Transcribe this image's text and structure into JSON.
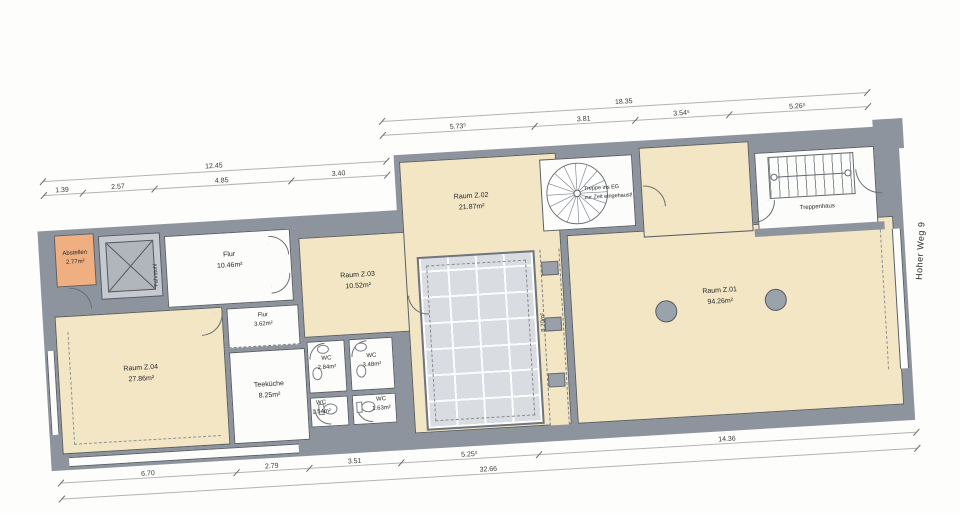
{
  "labels": {
    "street": "Hoher Weg 9",
    "treppenhaus": "Treppenhaus",
    "fahrstuhl": "Fahrstuhl",
    "lightwell_area": "8.70m²",
    "stair_note": [
      "Treppe ins EG",
      "zur Zeit eingehaust!"
    ]
  },
  "rooms": [
    {
      "name": "Abstellen",
      "area": "2.77m²"
    },
    {
      "name": "Flur",
      "area": "10.46m²"
    },
    {
      "name": "Raum Z.04",
      "area": "27.86m²"
    },
    {
      "name": "Flur",
      "area": "3.62m²"
    },
    {
      "name": "Teeküche",
      "area": "8.25m²"
    },
    {
      "name": "WC",
      "area": "2.84m²"
    },
    {
      "name": "WC",
      "area": "3.48m²"
    },
    {
      "name": "WC",
      "area": "1.54m²"
    },
    {
      "name": "WC",
      "area": "1.63m²"
    },
    {
      "name": "Raum Z.03",
      "area": "10.52m²"
    },
    {
      "name": "Raum Z.02",
      "area": "21.87m²"
    },
    {
      "name": "Raum Z.01",
      "area": "94.26m²"
    }
  ],
  "dimensions": {
    "top_left": {
      "total": "12.45",
      "segments": [
        "1.39",
        "2.57",
        "4.85",
        "3.40"
      ]
    },
    "top_right": {
      "total": "18.35",
      "segments": [
        "5.73⁵",
        "3.81",
        "3.54⁵",
        "5.26⁵"
      ]
    },
    "bottom": {
      "total": "32.66",
      "segments": [
        "6.70",
        "2.79",
        "3.51",
        "5.25⁵",
        "14.36"
      ]
    }
  },
  "colors": {
    "wall": "#8e949d",
    "room_beige": "#f3e6c4",
    "room_white": "#fcfcfa",
    "storage_salmon": "#f0af80",
    "skylight": "#d9dde2",
    "column": "#9aa2ab"
  }
}
